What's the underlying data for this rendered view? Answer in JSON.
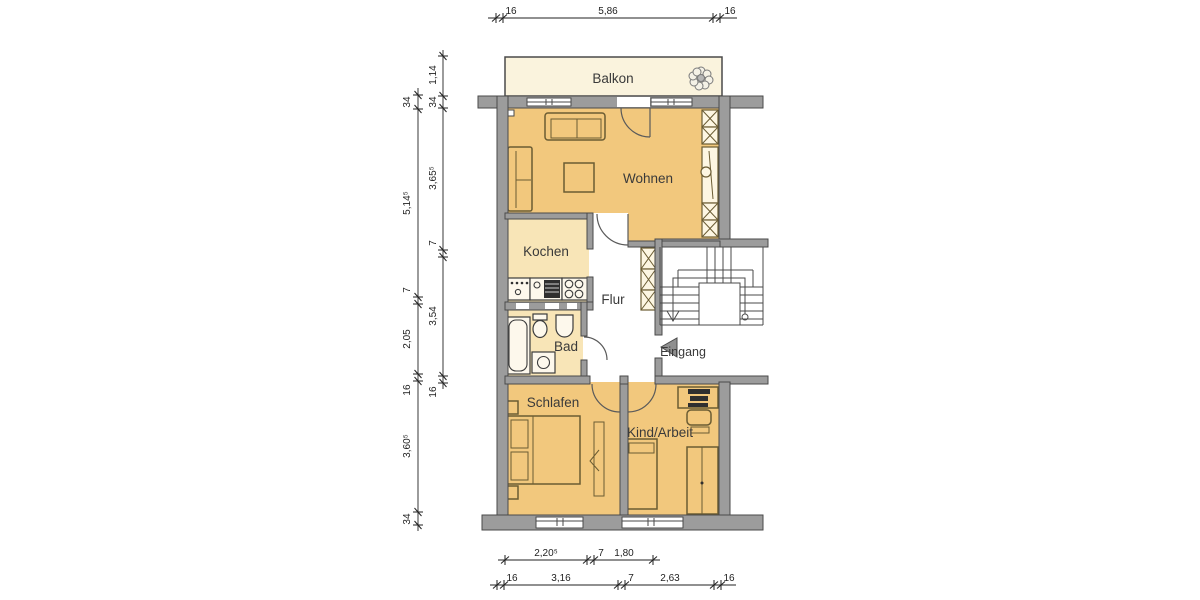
{
  "rooms": {
    "balkon": "Balkon",
    "wohnen": "Wohnen",
    "kochen": "Kochen",
    "flur": "Flur",
    "bad": "Bad",
    "schlafen": "Schlafen",
    "kind_arbeit": "Kind/Arbeit",
    "eingang": "Eingang"
  },
  "dimensions": {
    "top": [
      "16",
      "5,86",
      "16"
    ],
    "left_outer": [
      "34",
      "5,14⁵",
      "7",
      "2,05",
      "16",
      "3,60⁵",
      "34"
    ],
    "left_inner": [
      "1,14",
      "34",
      "3,65⁵",
      "7",
      "3,54",
      "16"
    ],
    "bottom_upper": [
      "2,20⁵",
      "7",
      "1,80"
    ],
    "bottom_lower": [
      "16",
      "3,16",
      "7",
      "2,63",
      "16"
    ]
  },
  "colors": {
    "wall_fill": "#9c9c9c",
    "wall_line": "#4a4a4a",
    "room_fill": "#f2c87d",
    "room_light_fill": "#f8e5b7",
    "balcony_fill": "#faf3dd",
    "furniture_line": "#6b5c33",
    "fixture_line": "#3c3c3c",
    "text": "#3a3a3a",
    "dim_line": "#222222"
  }
}
